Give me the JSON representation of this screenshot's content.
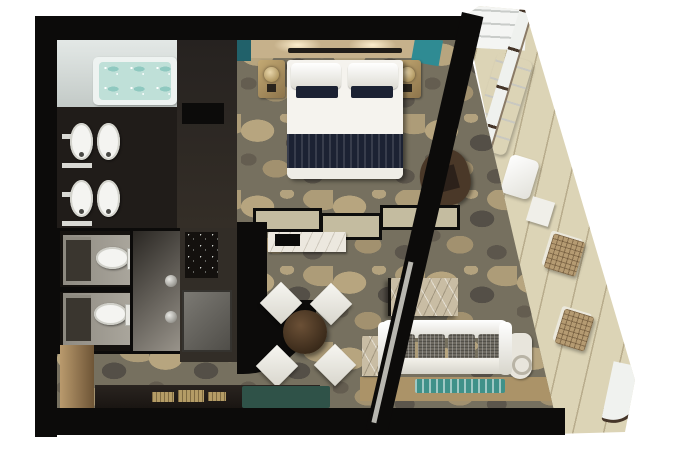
{
  "meta": {
    "kind": "floor-plan",
    "subject": "cruise-ship suite top-down 3d floor plan",
    "view": "top-down",
    "width_px": 680,
    "height_px": 457
  },
  "palette": {
    "page_bg": "#ffffff",
    "wall": "#0c0b0a",
    "carpet": "#76705f",
    "bath_floor": "#ccd2cf",
    "tub_water": "#bfe0d8",
    "vanity_dark": "#201c19",
    "closet": "#2e2923",
    "headboard_wall": "#c6b18b",
    "teal_accent": "#2f8b93",
    "teal_dark": "#21616a",
    "bed_white": "#f5f3ee",
    "bed_runner": "#1c2233",
    "nightstand_gold": "#ad9161",
    "partition_beige": "#c4bca0",
    "console_white": "#ece8df",
    "dining_table_wood": "#44311f",
    "chair_white": "#efede6",
    "marble": "#c9bda4",
    "sofa_white": "#edebe3",
    "cushion_gray": "#6e6a61",
    "floor_wood": "#ab9368",
    "rug_teal": "#3f9189",
    "balcony_floor": "#dcd4b6",
    "railing_frame": "#463629",
    "glass": "#eff1ee",
    "wc_floor": "#a9a59b",
    "metal_knob": "#9a9890",
    "desk_dark": "#1d1916",
    "gold": "#b49c66",
    "minibar": "#14110e",
    "mat_teal": "#2f5248",
    "cabinet_tan": "#8a6f4e"
  },
  "rooms": {
    "bathroom": {
      "name": "bathroom",
      "furniture": [
        "bathtub",
        "double-vanity-sinks-x4",
        "shelving-unit"
      ]
    },
    "water_closets": {
      "name": "water-closets",
      "furniture": [
        "toilet-1",
        "toilet-2",
        "shower-cabin",
        "storage-boxes"
      ]
    },
    "wardrobe": {
      "name": "wardrobe-closet",
      "furniture": [
        "closet-cabinet",
        "minibar",
        "service-door"
      ]
    },
    "bedroom": {
      "name": "bedroom",
      "furniture": [
        "king-bed",
        "pillows",
        "nightstand-left",
        "nightstand-right",
        "lamps",
        "armchair",
        "headboard-wall"
      ]
    },
    "living_room": {
      "name": "living-room",
      "furniture": [
        "round-dining-table",
        "dining-chairs-x4",
        "tv-console",
        "coffee-table-marble",
        "sofa",
        "side-table-left",
        "side-table-right",
        "desk",
        "desk-accessories",
        "teal-mat",
        "cabinet"
      ]
    },
    "balcony": {
      "name": "balcony",
      "furniture": [
        "privacy-divider",
        "lounge-chair-large",
        "lounge-chair-small",
        "side-table",
        "wicker-chair-1",
        "wicker-chair-2",
        "glass-railing"
      ]
    }
  }
}
